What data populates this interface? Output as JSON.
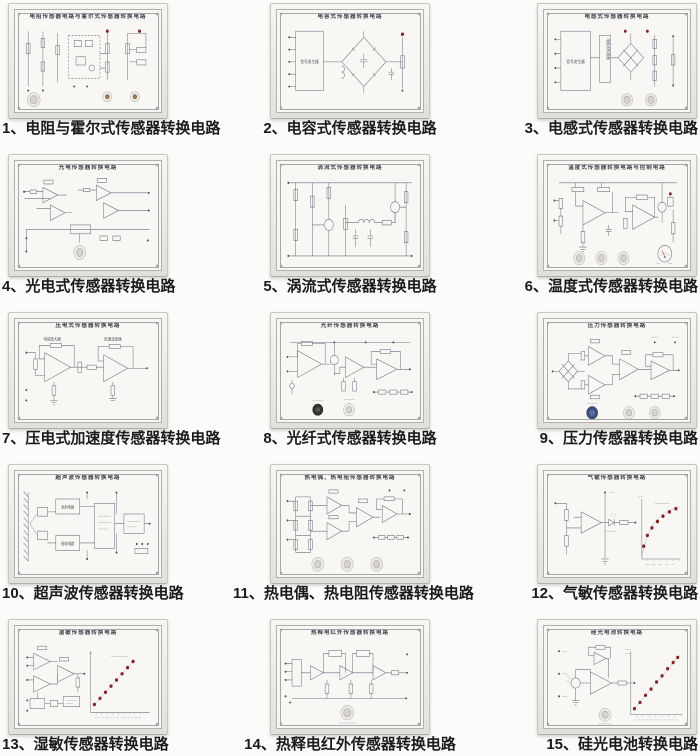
{
  "page": {
    "background": "#fcfbf9"
  },
  "colors": {
    "panel_face": "#f8f7f4",
    "panel_frame": "#e2e0db",
    "schematic_line": "#6a7080",
    "led_dot_red": "#8a2020",
    "caption_text": "#1b1b1b",
    "knob_dark": "#34322f",
    "knob_blue": "#3c4f7c",
    "knob_brass": "#9a7b4f"
  },
  "panels": [
    {
      "id": 1,
      "caption": "1、电阻与霍尔式传感器转换电路",
      "title": "电阻传感器电路与霍尔式传感器转换电路"
    },
    {
      "id": 2,
      "caption": "2、电容式传感器转换电路",
      "title": "电容式传感器转换电路",
      "labels": {
        "generator": "信号发生器"
      }
    },
    {
      "id": 3,
      "caption": "3、电感式传感器转换电路",
      "title": "电感式传感器转换电路",
      "labels": {
        "generator": "信号发生器",
        "sensor": "电感式传感器"
      }
    },
    {
      "id": 4,
      "caption": "4、光电式传感器转换电路",
      "title": "光电传感器转换电路"
    },
    {
      "id": 5,
      "caption": "5、涡流式传感器转换电路",
      "title": "涡流式传感器转换电路"
    },
    {
      "id": 6,
      "caption": "6、温度式传感器转换电路",
      "title": "温度式传感器转换电路与控制电路"
    },
    {
      "id": 7,
      "caption": "7、压电式加速度传感器转换电路",
      "title": "压电式传感器转换电路",
      "labels": {
        "left": "电荷放大器",
        "right": "低通滤波器"
      }
    },
    {
      "id": 8,
      "caption": "8、光纤式传感器转换电路",
      "title": "光纤传感器转换电路"
    },
    {
      "id": 9,
      "caption": "9、压力传感器转换电路",
      "title": "压力传感器转换电路"
    },
    {
      "id": 10,
      "caption": "10、超声波传感器转换电路",
      "title": "超声波传感器转换电路",
      "labels": {
        "transmit": "发射电路",
        "receive": "接收电路"
      }
    },
    {
      "id": 11,
      "caption": "11、热电偶、热电阻传感器转换电路",
      "title": "热电偶、热电阻传感器转换电路"
    },
    {
      "id": 12,
      "caption": "12、气敏传感器转换电路",
      "title": "气敏传感器转换电路"
    },
    {
      "id": 13,
      "caption": "13、湿敏传感器转换电路",
      "title": "湿敏传感器转换电路"
    },
    {
      "id": 14,
      "caption": "14、热释电红外传感器转换电路",
      "title": "热释电红外传感器转换电路"
    },
    {
      "id": 15,
      "caption": "15、硅光电池转换电路",
      "title": "硅光电池转换电路"
    }
  ]
}
